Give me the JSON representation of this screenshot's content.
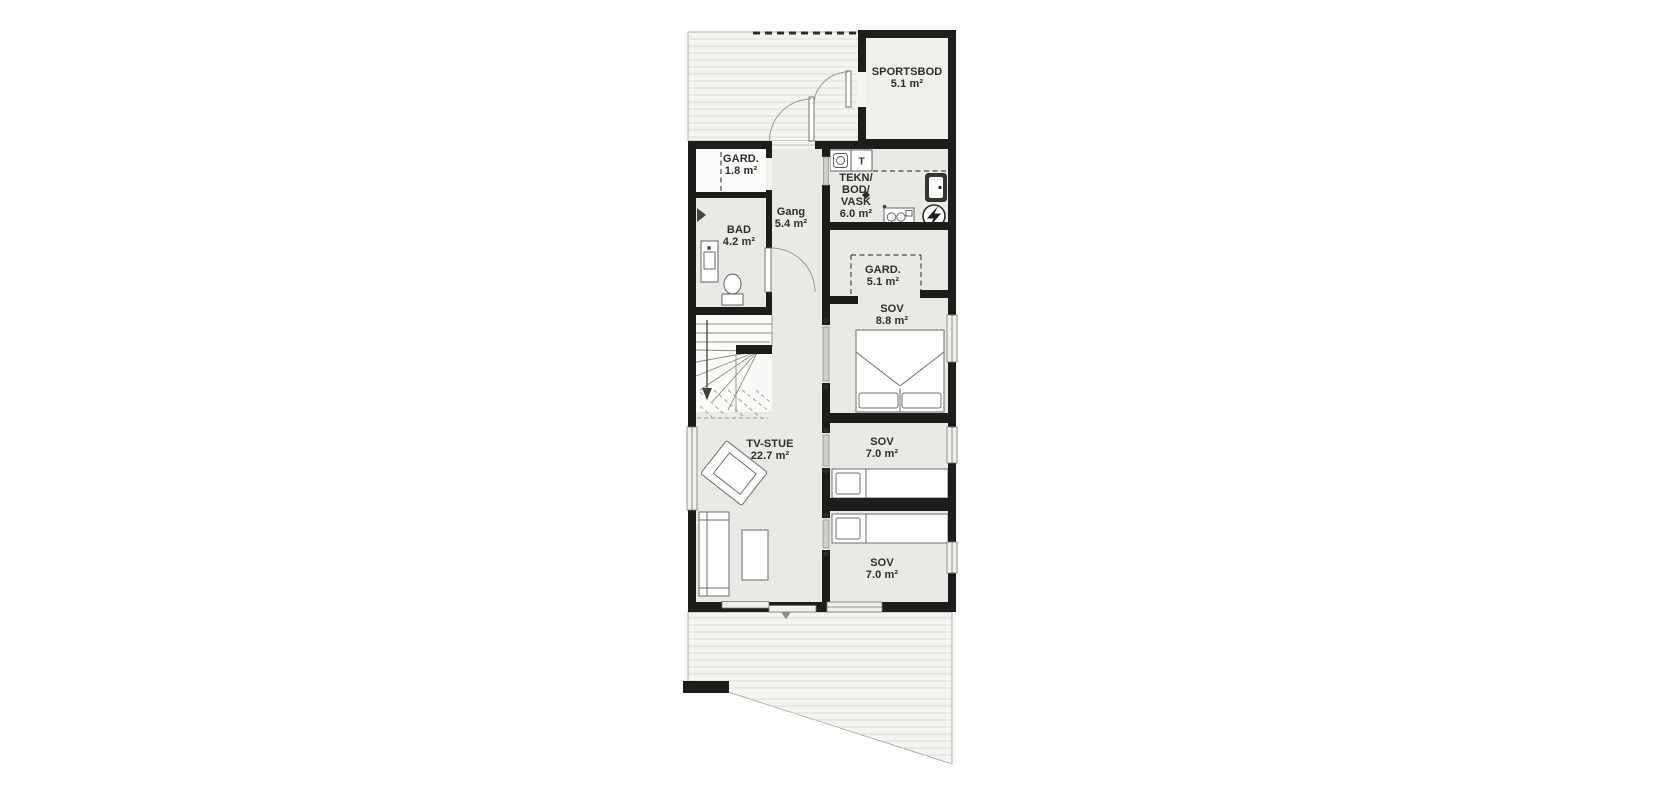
{
  "plan": {
    "type": "architectural-floor-plan",
    "colors": {
      "wall": "#1d1d1b",
      "floor": "#e9e9e5",
      "floor_light": "#fbfbf9",
      "deck": "#f4f4f1",
      "deck_line": "#dcdcd7",
      "text": "#2d2d2b"
    },
    "rooms": {
      "sportsbod": {
        "name": "SPORTSBOD",
        "area": "5.1 m²"
      },
      "gard_entry": {
        "name": "GARD.",
        "area": "1.8 m²"
      },
      "bad": {
        "name": "BAD",
        "area": "4.2 m²"
      },
      "gang": {
        "name": "Gang",
        "area": "5.4 m²"
      },
      "tekn": {
        "line1": "TEKN/",
        "line2": "BOD/",
        "line3": "VASK",
        "area": "6.0 m²"
      },
      "gard_sov": {
        "name": "GARD.",
        "area": "5.1 m²"
      },
      "sov_master": {
        "name": "SOV",
        "area": "8.8 m²"
      },
      "tv_stue": {
        "name": "TV-STUE",
        "area": "22.7 m²"
      },
      "sov_2": {
        "name": "SOV",
        "area": "7.0 m²"
      },
      "sov_3": {
        "name": "SOV",
        "area": "7.0 m²"
      }
    },
    "appliances": {
      "dryer_label": "T"
    }
  }
}
